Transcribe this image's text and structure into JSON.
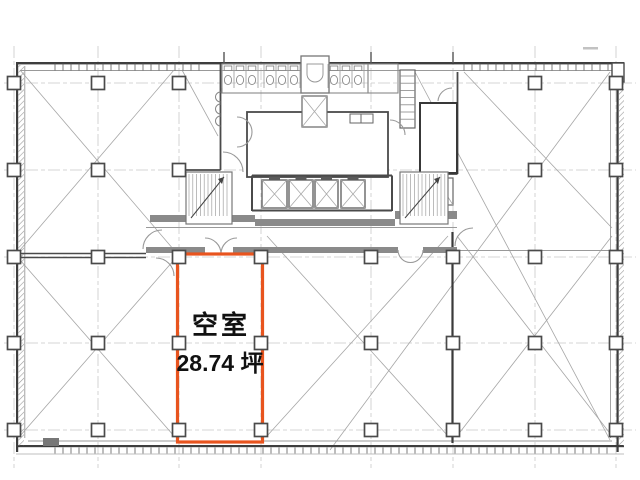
{
  "page": {
    "width": 640,
    "height": 480,
    "background": "#ffffff"
  },
  "plan": {
    "type": "building-floor-plan",
    "vacant_room": {
      "status_label": "空室",
      "area_label": "28.74 坪",
      "area_value": 28.74,
      "area_unit": "坪",
      "highlight_color": "#E8541E",
      "text_color": "#111111"
    },
    "colors": {
      "wall_dark": "#3d3d3d",
      "wall_mid": "#5a5a5a",
      "wall_band": "#8a8a8a",
      "thin_line": "#999999",
      "grid_line": "#c9c9c9",
      "diagonal_line": "#a6a6a6",
      "paper": "#ffffff"
    },
    "geometry": {
      "outline": {
        "x": 16,
        "y": 62,
        "w": 608,
        "h": 388
      },
      "grid": {
        "cols_x": [
          14,
          98,
          179,
          261,
          371,
          453,
          535,
          616
        ],
        "rows_y": [
          83,
          170,
          257,
          343,
          430
        ],
        "v_extent": [
          46,
          468
        ],
        "h_extent": [
          4,
          636
        ]
      },
      "columns": {
        "size": 13,
        "rows": [
          {
            "y": 83,
            "xs": [
              14,
              98,
              179,
              535,
              616
            ]
          },
          {
            "y": 170,
            "xs": [
              14,
              98,
              179,
              535,
              616
            ]
          },
          {
            "y": 257,
            "xs": [
              14,
              98,
              179,
              261,
              371,
              453,
              535,
              616
            ]
          },
          {
            "y": 343,
            "xs": [
              14,
              98,
              179,
              261,
              371,
              453,
              535,
              616
            ]
          },
          {
            "y": 430,
            "xs": [
              14,
              98,
              179,
              261,
              371,
              453,
              535,
              616
            ]
          }
        ]
      },
      "highlight_rect": {
        "x": 177.5,
        "y": 254,
        "w": 85,
        "h": 188,
        "stroke_width": 3.2
      },
      "diagonals": [
        [
          20,
          70,
          174,
          250
        ],
        [
          174,
          70,
          20,
          250
        ],
        [
          20,
          260,
          174,
          436
        ],
        [
          174,
          260,
          20,
          436
        ],
        [
          182,
          70,
          218,
          136
        ],
        [
          267,
          236,
          448,
          436
        ],
        [
          448,
          236,
          267,
          436
        ],
        [
          457,
          236,
          612,
          436
        ],
        [
          612,
          236,
          457,
          436
        ],
        [
          464,
          72,
          612,
          228
        ],
        [
          415,
          72,
          610,
          440
        ],
        [
          610,
          72,
          330,
          450
        ]
      ],
      "mullion_step": 8,
      "mullions_top": [
        [
          55,
          204
        ],
        [
          464,
          608
        ]
      ],
      "mullions_bottom": [
        [
          55,
          608
        ]
      ],
      "elevators": {
        "y": 180,
        "h": 28,
        "cars": [
          [
            262,
            25
          ],
          [
            289,
            24
          ],
          [
            315,
            23
          ],
          [
            341,
            24
          ]
        ]
      },
      "stairs": [
        {
          "x": 186,
          "y": 172,
          "w": 46,
          "h": 52
        },
        {
          "x": 400,
          "y": 172,
          "w": 48,
          "h": 52
        }
      ],
      "ladder_shaft": {
        "x": 400,
        "y": 70,
        "w": 15,
        "h": 58,
        "step": 7.2
      },
      "toilets": {
        "centers": [
          228,
          240,
          252,
          270,
          282,
          294,
          334,
          346,
          358
        ],
        "stall_xs": [
          222,
          234,
          246,
          258,
          264,
          276,
          288,
          300,
          328,
          340,
          352,
          364
        ]
      }
    }
  }
}
